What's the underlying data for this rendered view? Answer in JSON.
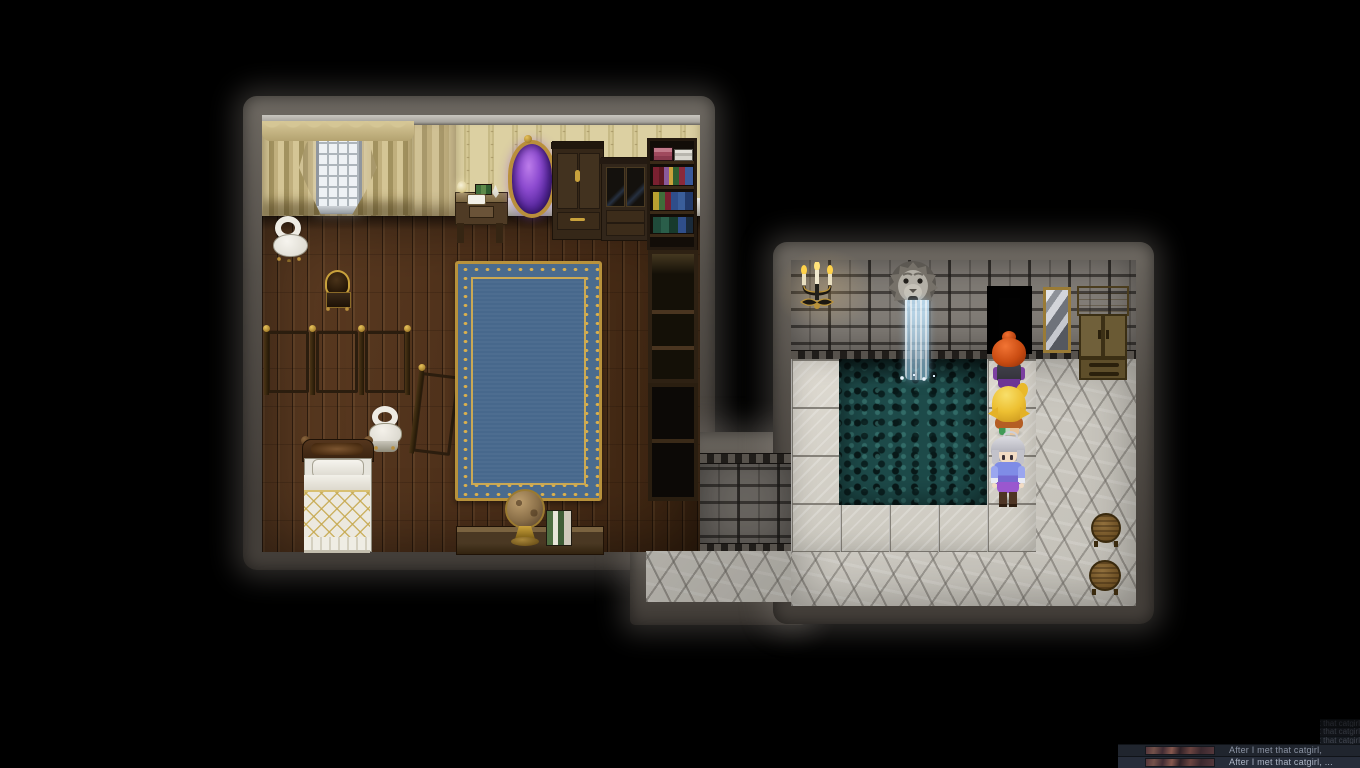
{
  "scene": {
    "type": "rpg-top-down-map",
    "left_room": "bedroom-study with window, curtains, arcane mirror, cabinets, bookshelf, folding screens, bed, rug, globe",
    "right_room": "bath-house with lion-head fountain, pool, candelabra, doorway, mirror, wardrobe, stools",
    "characters": [
      {
        "name": "red-haired-character",
        "hair": "#d85318",
        "facing": "up"
      },
      {
        "name": "blonde-character",
        "hair": "#eec233",
        "facing": "up"
      },
      {
        "name": "silver-haired-character",
        "hair": "#c6c6cc",
        "facing": "down"
      }
    ]
  },
  "palette": {
    "stone_border": "#57524c",
    "wood_floor": "#4a2e1a",
    "wallpaper": "#d3c694",
    "curtain": "#c6b687",
    "brick_wall": "#7d7974",
    "pool_water": "#1d4a49",
    "tile": "#d9d5cc",
    "cobble": "#cdcac2",
    "rug_field": "#47688c",
    "rug_gold": "#c9993c",
    "gold_accent": "#c9a23c",
    "arcane_mirror_purple": "#8d4bd0",
    "log_bg": "#20252e",
    "log_text": "#8b93a3"
  },
  "log_overlay": {
    "entries": [
      {
        "variant": "sliver",
        "text": "After I met that catgirl,"
      },
      {
        "variant": "sliver",
        "text": "After I met that catgirl,"
      },
      {
        "variant": "sliver",
        "text": "After I met that catgirl,"
      },
      {
        "variant": "main",
        "has_thumbnail": true,
        "text": "After I met that catgirl,"
      },
      {
        "variant": "main",
        "has_thumbnail": true,
        "text": "After I met that catgirl, ..."
      }
    ]
  }
}
